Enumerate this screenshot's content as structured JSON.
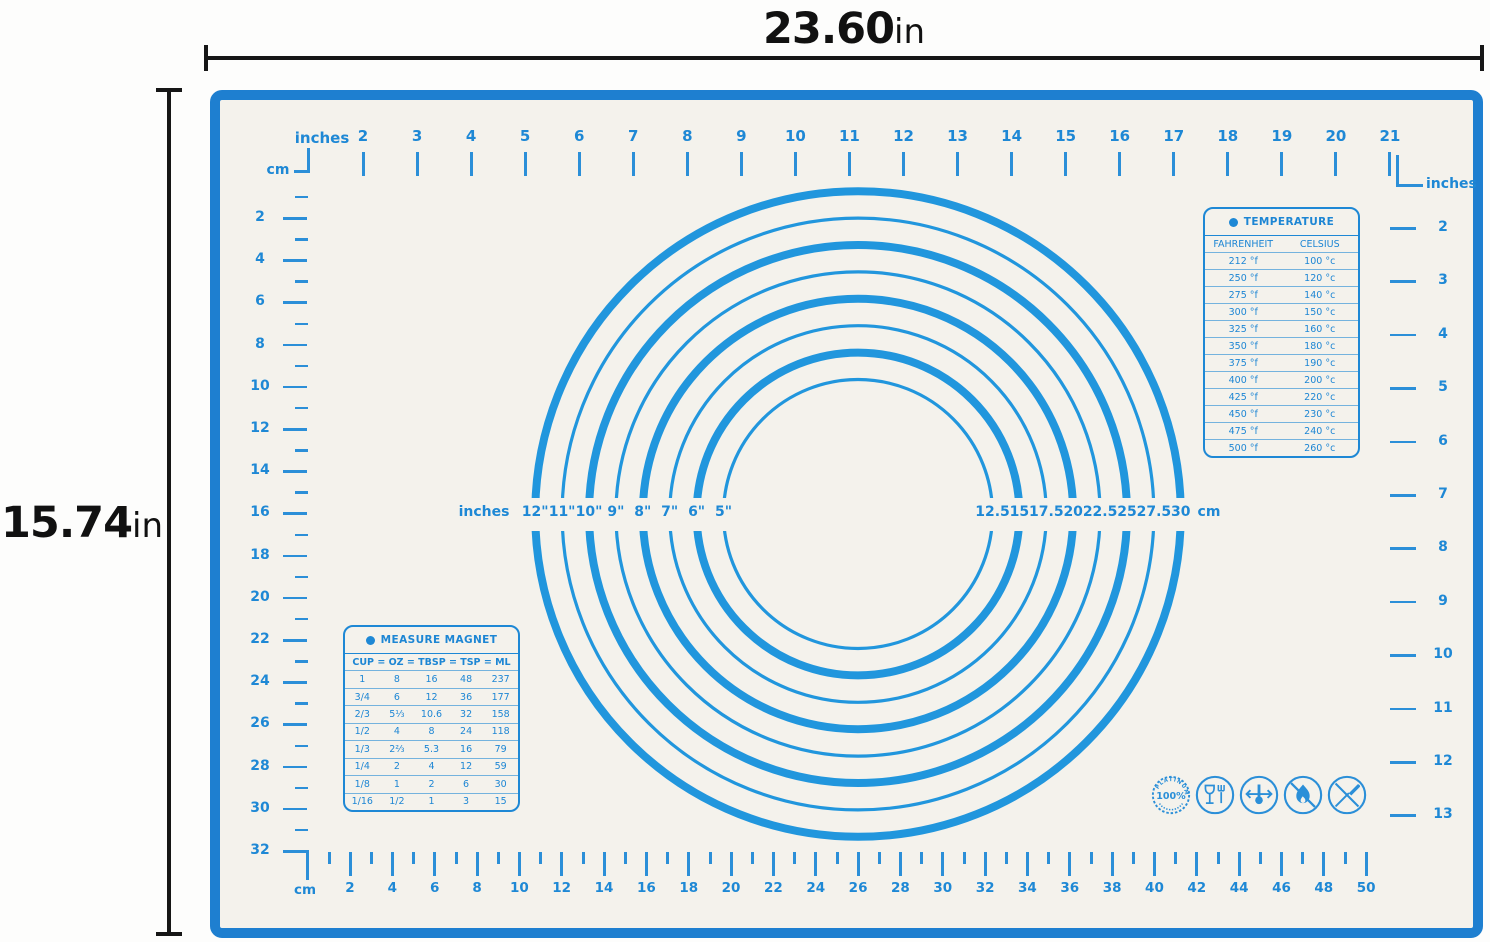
{
  "dimension_labels": {
    "width": {
      "value": "23.60",
      "unit": "in"
    },
    "height": {
      "value": "15.74",
      "unit": "in"
    }
  },
  "colors": {
    "mat_border_blue": "#1e7fd0",
    "marking_blue": "#1e88d5",
    "circle_blue": "#2196dd",
    "mat_surface": "#f4f2ec"
  },
  "top_ruler": {
    "unit": "inches",
    "corner_unit": "cm",
    "labels": [
      "2",
      "3",
      "4",
      "5",
      "6",
      "7",
      "8",
      "9",
      "10",
      "11",
      "12",
      "13",
      "14",
      "15",
      "16",
      "17",
      "18",
      "19",
      "20",
      "21"
    ]
  },
  "left_ruler": {
    "labels": [
      "2",
      "4",
      "6",
      "8",
      "10",
      "12",
      "14",
      "16",
      "18",
      "20",
      "22",
      "24",
      "26",
      "28",
      "30",
      "32"
    ]
  },
  "bottom_ruler": {
    "unit": "cm",
    "labels": [
      "2",
      "4",
      "6",
      "8",
      "10",
      "12",
      "14",
      "16",
      "18",
      "20",
      "22",
      "24",
      "26",
      "28",
      "30",
      "32",
      "34",
      "36",
      "38",
      "40",
      "42",
      "44",
      "46",
      "48",
      "50"
    ]
  },
  "right_ruler": {
    "unit": "inches",
    "labels": [
      "2",
      "3",
      "4",
      "5",
      "6",
      "7",
      "8",
      "9",
      "10",
      "11",
      "12",
      "13"
    ]
  },
  "circles": {
    "left_unit": "inches",
    "right_unit": "cm",
    "rings": [
      {
        "inch_label": "12\"",
        "cm_label": "30",
        "diameter_in": 12,
        "thick": true
      },
      {
        "inch_label": "11\"",
        "cm_label": "27.5",
        "diameter_in": 11,
        "thick": false
      },
      {
        "inch_label": "10\"",
        "cm_label": "25",
        "diameter_in": 10,
        "thick": true
      },
      {
        "inch_label": "9\"",
        "cm_label": "22.5",
        "diameter_in": 9,
        "thick": false
      },
      {
        "inch_label": "8\"",
        "cm_label": "20",
        "diameter_in": 8,
        "thick": true
      },
      {
        "inch_label": "7\"",
        "cm_label": "17.5",
        "diameter_in": 7,
        "thick": false
      },
      {
        "inch_label": "6\"",
        "cm_label": "15",
        "diameter_in": 6,
        "thick": true
      },
      {
        "inch_label": "5\"",
        "cm_label": "12.5",
        "diameter_in": 5,
        "thick": false
      }
    ]
  },
  "temperature_table": {
    "title": "TEMPERATURE",
    "columns": [
      "FAHRENHEIT",
      "CELSIUS"
    ],
    "rows": [
      [
        "212 °f",
        "100 °c"
      ],
      [
        "250 °f",
        "120 °c"
      ],
      [
        "275 °f",
        "140 °c"
      ],
      [
        "300 °f",
        "150 °c"
      ],
      [
        "325 °f",
        "160 °c"
      ],
      [
        "350 °f",
        "180 °c"
      ],
      [
        "375 °f",
        "190 °c"
      ],
      [
        "400 °f",
        "200 °c"
      ],
      [
        "425 °f",
        "220 °c"
      ],
      [
        "450 °f",
        "230 °c"
      ],
      [
        "475 °f",
        "240 °c"
      ],
      [
        "500 °f",
        "260 °c"
      ]
    ]
  },
  "measure_table": {
    "title": "MEASURE MAGNET",
    "header": "CUP = OZ = TBSP = TSP = ML",
    "rows": [
      [
        "1",
        "8",
        "16",
        "48",
        "237"
      ],
      [
        "3/4",
        "6",
        "12",
        "36",
        "177"
      ],
      [
        "2/3",
        "5⅓",
        "10.6",
        "32",
        "158"
      ],
      [
        "1/2",
        "4",
        "8",
        "24",
        "118"
      ],
      [
        "1/3",
        "2⅔",
        "5.3",
        "16",
        "79"
      ],
      [
        "1/4",
        "2",
        "4",
        "12",
        "59"
      ],
      [
        "1/8",
        "1",
        "2",
        "6",
        "30"
      ],
      [
        "1/16",
        "1/2",
        "1",
        "3",
        "15"
      ]
    ]
  },
  "badges": [
    {
      "name": "platinum-100-percent-badge",
      "text": "100%",
      "arc_text": "PLATINUM"
    },
    {
      "name": "food-contact-safe-icon"
    },
    {
      "name": "heat-resistant-icon"
    },
    {
      "name": "no-open-flame-icon"
    },
    {
      "name": "no-knife-cutting-icon"
    }
  ]
}
